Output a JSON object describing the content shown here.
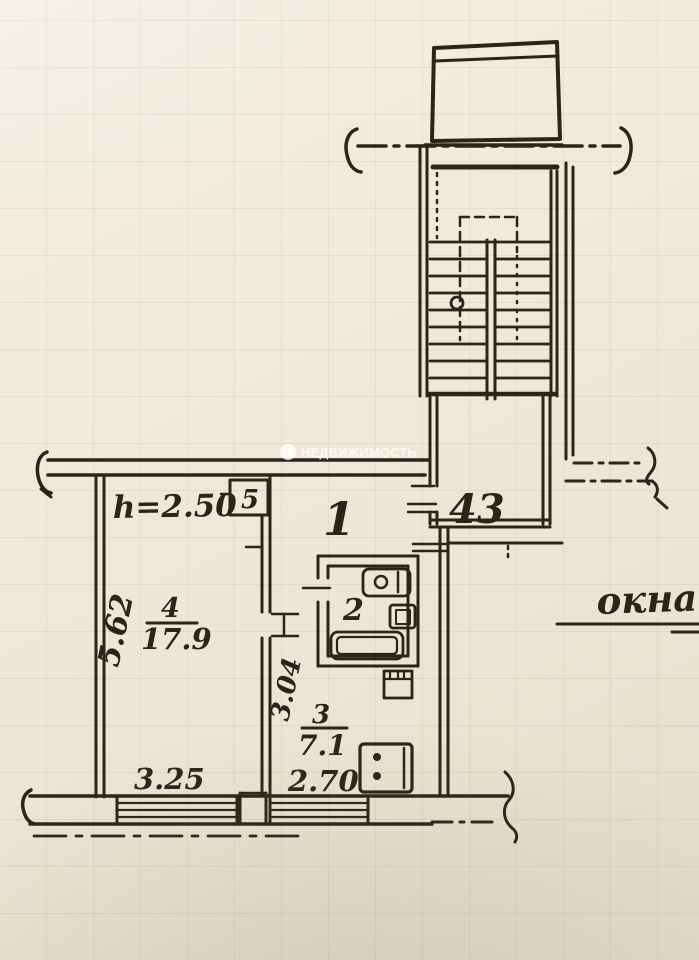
{
  "photo": {
    "description": "Hand-drawn apartment floor plan (technical passport sheet) photographed on graph paper"
  },
  "watermark": {
    "text": "НЕДВИЖИМОСТЬ"
  },
  "annotations": {
    "window_note": "окна",
    "ceiling_height": "h=2.50"
  },
  "rooms": {
    "hallway": {
      "number": "1"
    },
    "closet": {
      "number": "5"
    },
    "bathroom": {
      "number": "2"
    },
    "living_room": {
      "number": "4",
      "area": "17.9"
    },
    "kitchen": {
      "number": "3",
      "area": "7.1"
    },
    "stair_landing": {
      "number": "43"
    }
  },
  "dimensions": {
    "living_room_depth": "5.62",
    "living_room_window": "3.25",
    "kitchen_depth": "3.04",
    "kitchen_width": "2.70"
  },
  "colors": {
    "ink": "#2b241b",
    "paper": "#efe9db",
    "watermark_text": "#ffffff"
  }
}
